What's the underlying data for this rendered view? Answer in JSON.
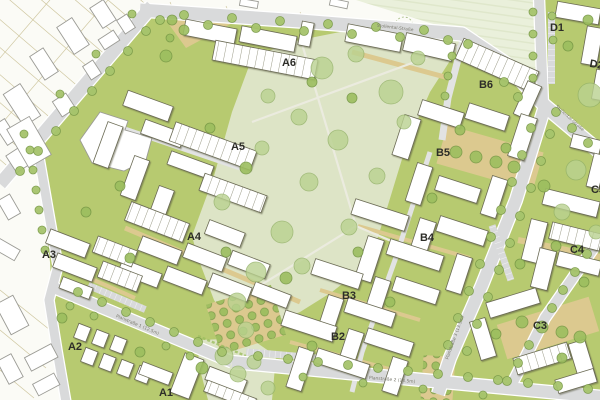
{
  "blocks": [
    {
      "id": "A1",
      "label": "A1"
    },
    {
      "id": "A2",
      "label": "A2"
    },
    {
      "id": "A3",
      "label": "A3"
    },
    {
      "id": "A4",
      "label": "A4"
    },
    {
      "id": "A5",
      "label": "A5"
    },
    {
      "id": "A6",
      "label": "A6"
    },
    {
      "id": "B2",
      "label": "B2"
    },
    {
      "id": "B3",
      "label": "B3"
    },
    {
      "id": "B4",
      "label": "B4"
    },
    {
      "id": "B5",
      "label": "B5"
    },
    {
      "id": "B6",
      "label": "B6"
    },
    {
      "id": "C3",
      "label": "C3"
    },
    {
      "id": "C4",
      "label": "C4"
    },
    {
      "id": "C5",
      "label": "C5"
    },
    {
      "id": "D1",
      "label": "D1"
    },
    {
      "id": "D2",
      "label": "D2"
    }
  ],
  "streets": {
    "main": "Stollental-Straße",
    "plan1": "Planstraße 1 (12.5m)",
    "plan2": "Planstraße 2 (14.5m)",
    "plan3": "Planstraße 3 (13.5m)"
  },
  "colors": {
    "base": "#fbfbf6",
    "field": "#e9eed9",
    "block_green": "#b7ca70",
    "park": "#dde4c6",
    "road": "#d9dadb",
    "road_minor": "#e2e3e3",
    "tan": "#dcc98f",
    "tree_fill": "#a6c46c",
    "tree_stroke": "#7c9c4b",
    "park_tree": "#bad290",
    "bldg_stroke": "#6b6b54",
    "exist_stroke": "#9b9b95",
    "parcel": "#cfc7a0",
    "label": "#2d2d28",
    "street_label": "#7b7b70"
  }
}
